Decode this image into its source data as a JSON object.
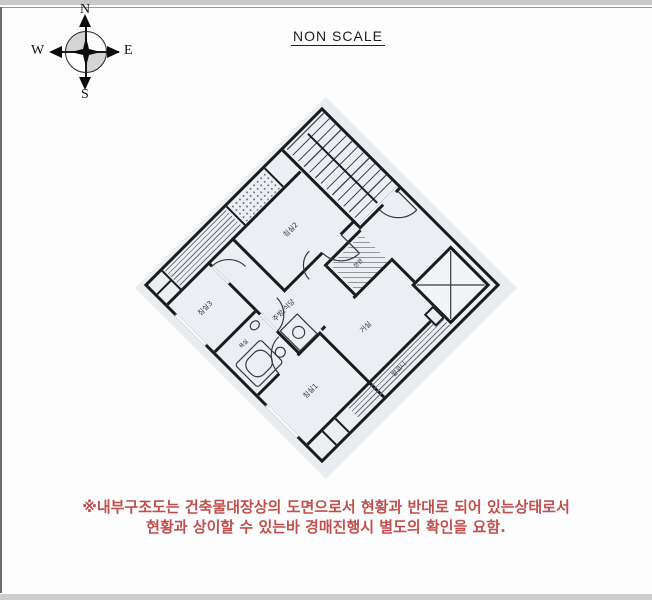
{
  "page": {
    "scale_note": "NON SCALE"
  },
  "compass": {
    "north": "N",
    "south": "S",
    "east": "E",
    "west": "W"
  },
  "floor_plan": {
    "rooms": {
      "bedroom1": "침실1",
      "bedroom2": "침실2",
      "bedroom3": "침실3",
      "living": "거실",
      "kitchen": "주방/식당",
      "bathroom": "욕실",
      "entry": "현관",
      "balcony": "발코니"
    }
  },
  "disclaimer": {
    "line1": "※내부구조도는 건축물대장상의 도면으로서 현황과 반대로 되어 있는상태로서",
    "line2": "현황과 상이할 수 있는바 경매진행시 별도의 확인을 요함."
  },
  "colors": {
    "accent_red": "#c0504d",
    "scan_tint": "#e9edf2",
    "wall": "#1b1b1b"
  }
}
